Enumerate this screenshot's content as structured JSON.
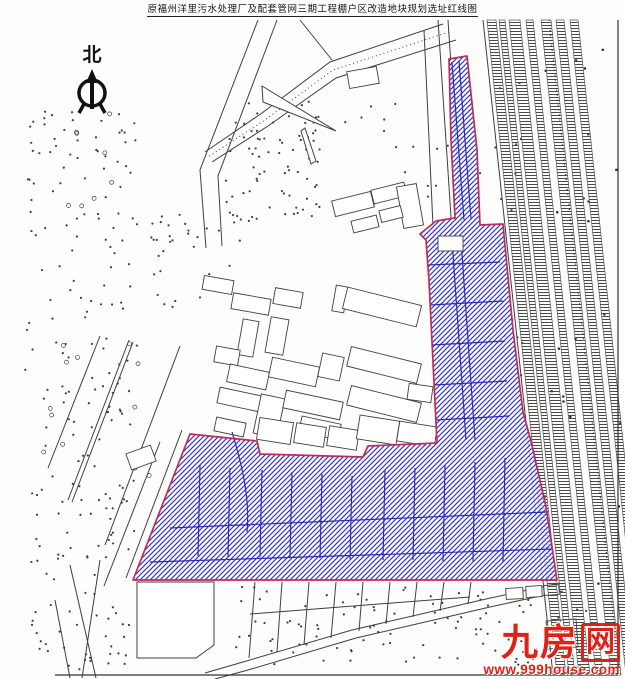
{
  "title": {
    "text": "原福州洋里污水处理厂及配套管网三期工程棚户区改造地块规划选址红线图"
  },
  "north_arrow": {
    "label": "北"
  },
  "watermark": {
    "name_left": "九房",
    "name_boxed": "网",
    "url": "www.999house.com"
  },
  "colors": {
    "red_line": "#bf2a5a",
    "hatch_blue": "#3232c6",
    "parcel_blue": "#2a2ab8",
    "ink": "#3f3f3f",
    "square_ink": "#222222",
    "watermark_red": "#df2118"
  },
  "geometry": {
    "canvas": {
      "w": 625,
      "h": 679
    },
    "frame": {
      "segments": [
        [
          618,
          20,
          618,
          675
        ],
        [
          55,
          675,
          618,
          675
        ]
      ]
    },
    "red_line_area": {
      "outer": [
        [
          449,
          59
        ],
        [
          467,
          56
        ],
        [
          477,
          150
        ],
        [
          480,
          225
        ],
        [
          503,
          224
        ],
        [
          513,
          330
        ],
        [
          523,
          412
        ],
        [
          531,
          441
        ],
        [
          546,
          507
        ],
        [
          557,
          580
        ],
        [
          133,
          580
        ],
        [
          190,
          434
        ],
        [
          257,
          441
        ],
        [
          260,
          454
        ],
        [
          363,
          457
        ],
        [
          368,
          446
        ],
        [
          437,
          443
        ],
        [
          429,
          281
        ],
        [
          426,
          240
        ],
        [
          420,
          234
        ],
        [
          436,
          221
        ],
        [
          455,
          218
        ],
        [
          451,
          140
        ]
      ],
      "notch": [
        438,
        236,
        25,
        15
      ],
      "curve": "M232,432 C243,468 250,500 247,532",
      "inner_lines": [
        [
          200,
          465,
          198,
          556
        ],
        [
          230,
          468,
          228,
          557
        ],
        [
          262,
          470,
          260,
          557
        ],
        [
          292,
          472,
          290,
          558
        ],
        [
          322,
          474,
          320,
          558
        ],
        [
          352,
          476,
          350,
          559
        ],
        [
          385,
          470,
          383,
          560
        ],
        [
          415,
          468,
          413,
          560
        ],
        [
          445,
          465,
          443,
          561
        ],
        [
          475,
          462,
          473,
          561
        ],
        [
          505,
          458,
          503,
          562
        ],
        [
          150,
          562,
          553,
          549
        ],
        [
          170,
          528,
          548,
          512
        ],
        [
          428,
          265,
          500,
          262
        ],
        [
          430,
          305,
          503,
          301
        ],
        [
          432,
          345,
          505,
          341
        ],
        [
          434,
          385,
          507,
          381
        ],
        [
          436,
          420,
          509,
          416
        ],
        [
          452,
          240,
          466,
          440
        ],
        [
          461,
          240,
          475,
          440
        ],
        [
          452,
          62,
          464,
          220
        ],
        [
          459,
          61,
          471,
          219
        ]
      ]
    },
    "railway": {
      "y_top": 20,
      "y_bottom": 675,
      "drift": 70,
      "boundary_left": [
        483,
        20,
        553,
        675
      ],
      "bands": [
        [
          487,
          9
        ],
        [
          499,
          6
        ],
        [
          509,
          11
        ],
        [
          526,
          7
        ],
        [
          541,
          10
        ],
        [
          556,
          8
        ],
        [
          570,
          8
        ]
      ],
      "dotted": [
        [
          549,
          20
        ],
        [
          619,
          670
        ]
      ]
    },
    "roads": [
      {
        "pts": [
          [
            258,
            20
          ],
          [
            200,
            170
          ],
          [
            206,
            248
          ]
        ]
      },
      {
        "pts": [
          [
            277,
            20
          ],
          [
            218,
            176
          ],
          [
            222,
            246
          ]
        ]
      },
      {
        "pts": [
          [
            443,
            24
          ],
          [
            330,
            62
          ],
          [
            262,
            113
          ],
          [
            205,
            152
          ]
        ]
      },
      {
        "pts": [
          [
            456,
            40
          ],
          [
            336,
            78
          ],
          [
            268,
            126
          ],
          [
            212,
            162
          ]
        ]
      },
      {
        "pts": [
          [
            449,
            32
          ],
          [
            333,
            70
          ],
          [
            265,
            120
          ],
          [
            208,
            157
          ]
        ],
        "dash": "1 3"
      },
      {
        "pts": [
          [
            560,
            583
          ],
          [
            486,
            599
          ],
          [
            352,
            630
          ],
          [
            243,
            662
          ],
          [
            205,
            673
          ]
        ]
      },
      {
        "pts": [
          [
            563,
            591
          ],
          [
            490,
            607
          ],
          [
            356,
            638
          ],
          [
            248,
            670
          ],
          [
            215,
            679
          ]
        ]
      }
    ],
    "segments": [
      [
        438,
        20,
        452,
        232
      ],
      [
        448,
        20,
        462,
        230
      ],
      [
        424,
        30,
        434,
        248
      ],
      [
        300,
        20,
        332,
        60
      ],
      [
        100,
        336,
        48,
        468
      ],
      [
        129,
        340,
        68,
        500
      ],
      [
        133,
        342,
        72,
        502
      ],
      [
        180,
        346,
        105,
        545
      ],
      [
        70,
        565,
        96,
        678
      ],
      [
        100,
        560,
        82,
        678
      ],
      [
        55,
        600,
        70,
        678
      ],
      [
        182,
        430,
        126,
        578
      ],
      [
        160,
        442,
        104,
        586
      ],
      [
        255,
        582,
        249,
        658
      ],
      [
        282,
        582,
        277,
        652
      ],
      [
        309,
        582,
        304,
        645
      ],
      [
        336,
        582,
        331,
        638
      ],
      [
        363,
        582,
        359,
        631
      ],
      [
        390,
        582,
        386,
        624
      ],
      [
        417,
        582,
        413,
        617
      ],
      [
        444,
        582,
        440,
        611
      ],
      [
        471,
        582,
        468,
        604
      ],
      [
        250,
        614,
        470,
        597
      ]
    ],
    "polygons": [
      [
        [
          262,
          86
        ],
        [
          336,
          131
        ],
        [
          263,
          102
        ]
      ],
      [
        [
          305,
          128
        ],
        [
          316,
          161
        ],
        [
          311,
          164
        ],
        [
          301,
          131
        ]
      ],
      [
        [
          137,
          582
        ],
        [
          214,
          582
        ],
        [
          214,
          645
        ],
        [
          196,
          658
        ],
        [
          137,
          658
        ]
      ]
    ],
    "buildings": [
      [
        348,
        69,
        30,
        17,
        -10
      ],
      [
        333,
        196,
        40,
        16,
        -14
      ],
      [
        372,
        186,
        34,
        14,
        -14
      ],
      [
        400,
        185,
        20,
        42,
        -10
      ],
      [
        352,
        218,
        26,
        12,
        -14
      ],
      [
        380,
        208,
        22,
        12,
        -14
      ],
      [
        203,
        278,
        30,
        14,
        10
      ],
      [
        232,
        296,
        38,
        16,
        10
      ],
      [
        274,
        290,
        28,
        16,
        10
      ],
      [
        334,
        286,
        12,
        26,
        10
      ],
      [
        344,
        296,
        76,
        22,
        14
      ],
      [
        268,
        318,
        18,
        36,
        10
      ],
      [
        240,
        320,
        16,
        36,
        10
      ],
      [
        215,
        348,
        24,
        16,
        10
      ],
      [
        228,
        368,
        40,
        18,
        12
      ],
      [
        270,
        362,
        48,
        20,
        12
      ],
      [
        320,
        355,
        22,
        24,
        12
      ],
      [
        348,
        355,
        72,
        20,
        14
      ],
      [
        218,
        392,
        48,
        16,
        12
      ],
      [
        257,
        396,
        24,
        40,
        12
      ],
      [
        284,
        396,
        58,
        18,
        12
      ],
      [
        348,
        394,
        72,
        20,
        14
      ],
      [
        300,
        420,
        40,
        16,
        12
      ],
      [
        215,
        420,
        30,
        14,
        12
      ],
      [
        258,
        420,
        34,
        22,
        9
      ],
      [
        295,
        425,
        30,
        20,
        9
      ],
      [
        328,
        428,
        30,
        20,
        9
      ],
      [
        358,
        418,
        40,
        24,
        9
      ],
      [
        398,
        424,
        38,
        20,
        9
      ],
      [
        408,
        385,
        24,
        16,
        8
      ],
      [
        506,
        588,
        17,
        11,
        -3
      ],
      [
        526,
        586,
        16,
        11,
        -3
      ],
      [
        544,
        585,
        15,
        10,
        -3
      ],
      [
        547,
        620,
        30,
        28,
        -4
      ],
      [
        128,
        449,
        26,
        17,
        -20
      ]
    ],
    "dot_regions": [
      [
        25,
        110,
        115,
        450,
        150,
        "dot"
      ],
      [
        225,
        100,
        95,
        125,
        80,
        "dot"
      ],
      [
        345,
        95,
        110,
        120,
        18,
        "dot"
      ],
      [
        470,
        80,
        55,
        340,
        22,
        "dot"
      ],
      [
        235,
        585,
        250,
        80,
        70,
        "dot"
      ],
      [
        480,
        598,
        110,
        70,
        30,
        "dot"
      ],
      [
        30,
        480,
        100,
        190,
        60,
        "dot"
      ],
      [
        150,
        210,
        90,
        100,
        30,
        "dot"
      ],
      [
        40,
        330,
        120,
        160,
        12,
        "circle"
      ],
      [
        60,
        90,
        60,
        120,
        8,
        "circle"
      ],
      [
        540,
        25,
        80,
        645,
        22,
        "square"
      ]
    ]
  }
}
